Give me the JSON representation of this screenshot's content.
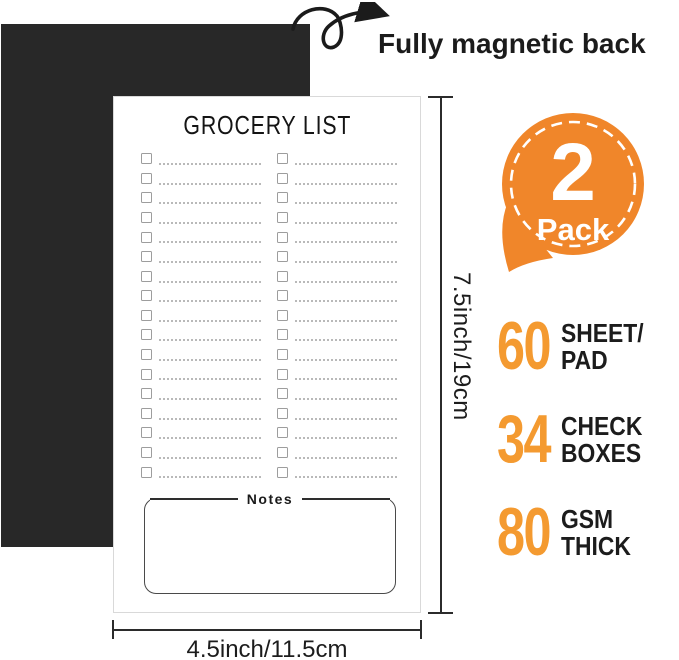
{
  "header": {
    "annotation": "Fully magnetic back"
  },
  "badge": {
    "big_text": "2",
    "small_text": "Pack"
  },
  "notepad": {
    "title": "GROCERY LIST",
    "notes_label": "Notes",
    "columns": 2,
    "rows_per_column": 17
  },
  "dimensions": {
    "height_label": "7.5inch/19cm",
    "width_label": "4.5inch/11.5cm"
  },
  "stats": [
    {
      "value": "60",
      "label_line1": "SHEET/",
      "label_line2": "PAD"
    },
    {
      "value": "34",
      "label_line1": "CHECK",
      "label_line2": "BOXES"
    },
    {
      "value": "80",
      "label_line1": "GSM",
      "label_line2": "THICK"
    }
  ],
  "colors": {
    "badge_orange": "#F0862A",
    "stat_orange": "#F49A30",
    "magnet_black": "#282828",
    "line_dark": "#2b2b2b"
  }
}
